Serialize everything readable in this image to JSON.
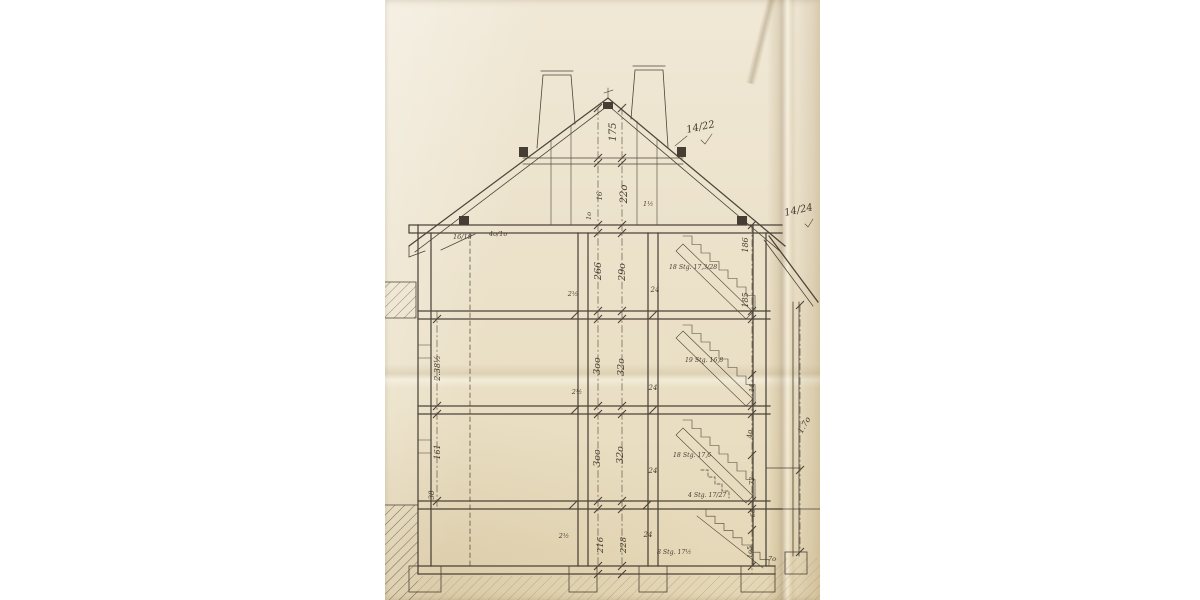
{
  "colors": {
    "background": "#ffffff",
    "paper": "#ece2cb",
    "ink": "#3b332a"
  },
  "annotations": [
    {
      "id": "dim-ridge-175",
      "text": "175"
    },
    {
      "id": "dim-attic-220",
      "text": "22o"
    },
    {
      "id": "dim-collar-16",
      "text": "16"
    },
    {
      "id": "dim-collar-10",
      "text": "1o"
    },
    {
      "id": "rafter-size-14-22",
      "text": "14/22"
    },
    {
      "id": "rafter-size-14-24",
      "text": "14/24"
    },
    {
      "id": "beam-size-16-18",
      "text": "16/18"
    },
    {
      "id": "beam-size-40-10",
      "text": "4o/1o"
    },
    {
      "id": "dim-1-half",
      "text": "1½"
    },
    {
      "id": "dim-attic-room-266",
      "text": "266"
    },
    {
      "id": "dim-attic-floor-290",
      "text": "29o"
    },
    {
      "id": "stair-attic-label",
      "text": "18 Stg. 17,3/28"
    },
    {
      "id": "tick-2half-attic",
      "text": "2½"
    },
    {
      "id": "tick-24-attic",
      "text": "24"
    },
    {
      "id": "dim-left-238half",
      "text": "2.38½"
    },
    {
      "id": "dim-room-300-a",
      "text": "3oo"
    },
    {
      "id": "dim-floor-320-a",
      "text": "32o"
    },
    {
      "id": "stair-mid-label",
      "text": "19 Stg. 16,8"
    },
    {
      "id": "tick-2half-mid",
      "text": "2½"
    },
    {
      "id": "tick-24-mid",
      "text": "24"
    },
    {
      "id": "dim-left-161",
      "text": "161"
    },
    {
      "id": "dim-room-300-b",
      "text": "3oo"
    },
    {
      "id": "dim-floor-320-b",
      "text": "32o"
    },
    {
      "id": "stair-lower-label",
      "text": "18 Stg. 17,6"
    },
    {
      "id": "tick-24-lower",
      "text": "24"
    },
    {
      "id": "dim-left-38",
      "text": "38"
    },
    {
      "id": "stair-entry-label",
      "text": "4 Stg. 17/27"
    },
    {
      "id": "dim-right-186",
      "text": "186"
    },
    {
      "id": "dim-right-185",
      "text": "185"
    },
    {
      "id": "dim-right-14",
      "text": "14"
    },
    {
      "id": "dim-right-40",
      "text": "4o"
    },
    {
      "id": "dim-right-72",
      "text": "72"
    },
    {
      "id": "dim-right-66",
      "text": "66"
    },
    {
      "id": "dim-right-105",
      "text": "1o5"
    },
    {
      "id": "dim-right-70",
      "text": "7o"
    },
    {
      "id": "dim-right-170",
      "text": "1.7o"
    },
    {
      "id": "dim-cellar-216",
      "text": "216"
    },
    {
      "id": "dim-cellar-228",
      "text": "228"
    },
    {
      "id": "tick-2half-cellar",
      "text": "2½"
    },
    {
      "id": "tick-24-cellar",
      "text": "24"
    },
    {
      "id": "stair-cellar-label",
      "text": "8 Stg. 17½"
    }
  ]
}
